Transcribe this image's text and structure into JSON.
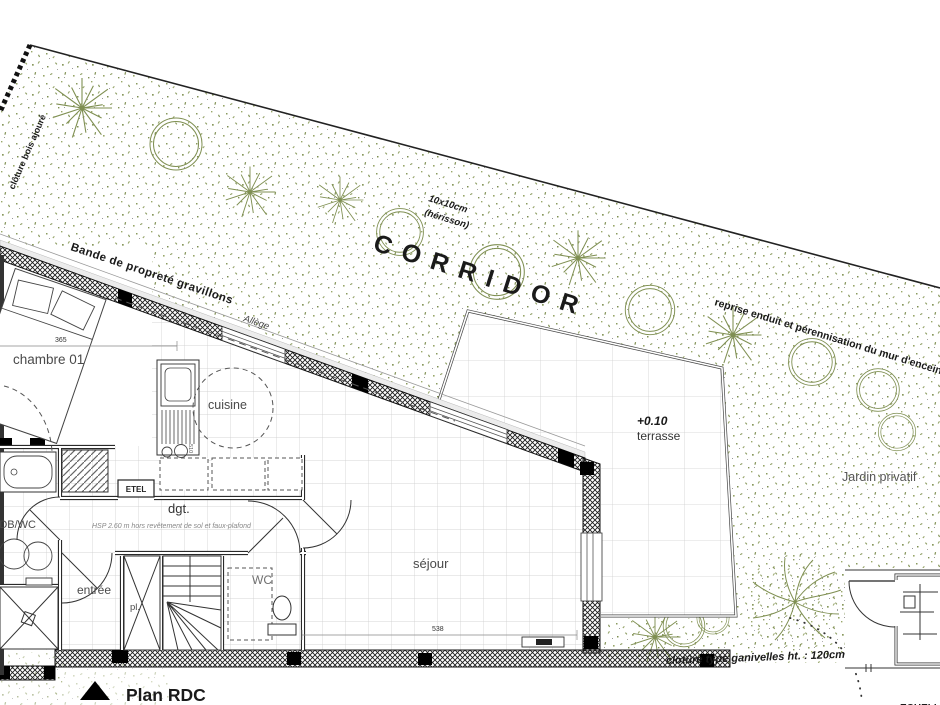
{
  "colors": {
    "paper": "#ffffff",
    "ink": "#1a1a1a",
    "vegetation": "#7f8f52",
    "tile_grid": "#c9c9c9",
    "wall_hatch": "#222222",
    "muted_text": "#555555"
  },
  "title": {
    "label": "Plan RDC"
  },
  "site": {
    "corridor": "CORRIDOR",
    "herisson_line1": "10x10cm",
    "herisson_line2": "(hérisson)",
    "cloture_bois": "clôture bois ajouré",
    "bande_proprete": "Bande de propreté gravillons",
    "allege": "Allège",
    "reprise_enduit": "reprise enduit et pérennisation du mur d'enceinte",
    "jardin_privatif": "Jardin privatif",
    "cloture_ganivelles": "clotûre type ganivelles ht. : 120cm",
    "terrasse_level": "+0.10",
    "terrasse_label": "terrasse",
    "echelle_partial": "ECHELLE"
  },
  "rooms": {
    "chambre": "chambre 01",
    "cuisine": "cuisine",
    "sejour": "séjour",
    "degagement": "dgt.",
    "hsp_note": "HSP 2.60 m hors revêtement de sol et faux-plafond",
    "entree": "entrée",
    "placard": "pl.",
    "wc": "WC",
    "sdb": "SDB/WC",
    "etel": "ETEL"
  },
  "dimensions": {
    "chambre_width": "365",
    "sejour_width": "538",
    "kitchen_depth": "510"
  }
}
